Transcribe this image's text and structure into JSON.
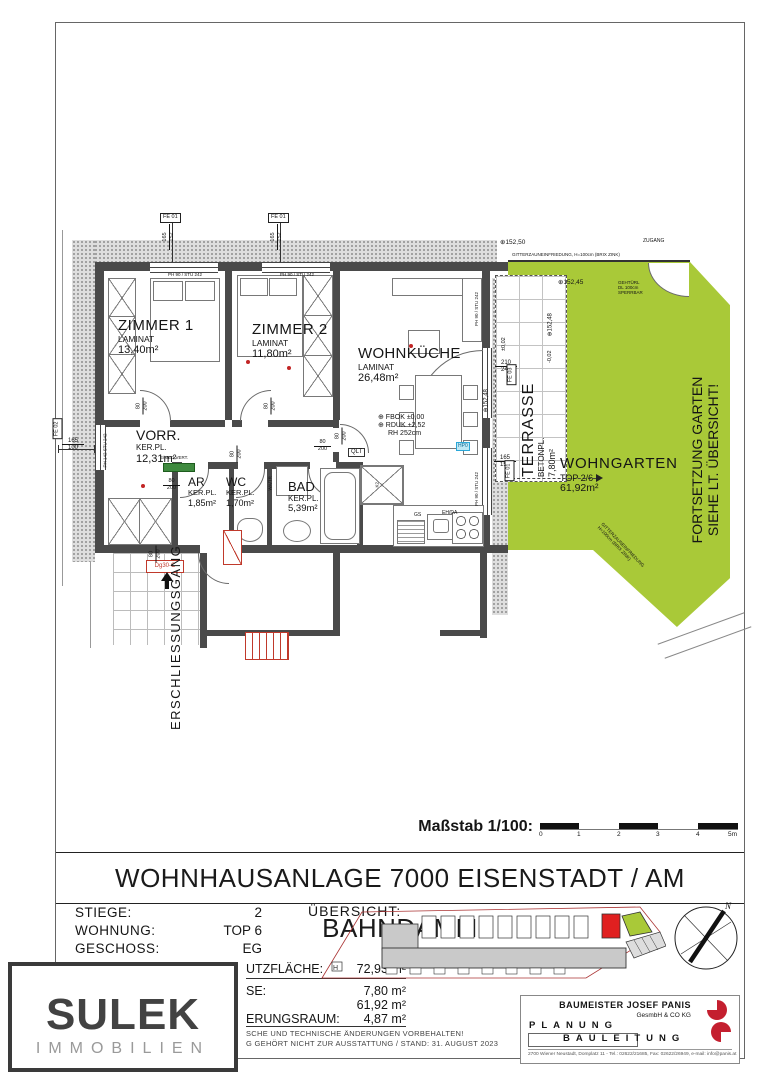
{
  "title": "WOHNHAUSANLAGE 7000 EISENSTADT / AM BAHNDAMM",
  "scalebar": {
    "label": "Maßstab 1/100:",
    "ticks": [
      "0",
      "1",
      "2",
      "3",
      "4",
      "5m"
    ]
  },
  "info": {
    "rows": [
      {
        "label": "STIEGE:",
        "value": "2"
      },
      {
        "label": "WOHNUNG:",
        "value": "TOP 6"
      },
      {
        "label": "GESCHOSS:",
        "value": "EG"
      }
    ],
    "areas": [
      {
        "label": "UTZFLÄCHE:",
        "value": "72,93 m²"
      },
      {
        "label": "SE:",
        "value": "7,80 m²"
      },
      {
        "label": "",
        "value": "61,92 m²"
      },
      {
        "label": "ERUNGSRAUM:",
        "value": "4,87 m²"
      }
    ],
    "uebersicht": "ÜBERSICHT:",
    "disclaimer1": "SCHE UND TECHNISCHE ÄNDERUNGEN VORBEHALTEN!",
    "disclaimer2": "G GEHÖRT NICHT ZUR AUSSTATTUNG / STAND: 31. AUGUST 2023"
  },
  "logo": {
    "name": "SULEK",
    "subtitle": "IMMOBILIEN"
  },
  "architect": {
    "name": "BAUMEISTER JOSEF PANIS",
    "legal": "GesmbH & CO KG",
    "planung": "PLANUNG",
    "bauleitung": "BAULEITUNG",
    "address": "2700 Wiener Neustadt, Domplatz 11 - Tel.: 02622/21685, Fax: 02622/26949, e-mail: info@panis.at"
  },
  "compass": {
    "north": "N"
  },
  "rooms": {
    "zimmer1": {
      "name": "ZIMMER 1",
      "floor": "LAMINAT",
      "area": "13,40m²"
    },
    "zimmer2": {
      "name": "ZIMMER 2",
      "floor": "LAMINAT",
      "area": "11,80m²"
    },
    "wohnkueche": {
      "name": "WOHNKÜCHE",
      "floor": "LAMINAT",
      "area": "26,48m²"
    },
    "vorraum": {
      "name": "VORR.",
      "floor": "KER.PL.",
      "area": "12,31m²"
    },
    "abstellraum": {
      "name": "AR",
      "floor": "KER.PL.",
      "area": "1,85m²"
    },
    "wc": {
      "name": "WC",
      "floor": "KER.PL.",
      "area": "1,70m²"
    },
    "bad": {
      "name": "BAD",
      "floor": "KER.PL.",
      "area": "5,39m²"
    },
    "terrasse": {
      "name": "TERRASSE",
      "floor": "BETONPL.",
      "area": "7,80m²"
    },
    "wohngarten": {
      "name": "WOHNGARTEN",
      "top": "TOP 2/6",
      "area": "61,92m²"
    }
  },
  "labels": {
    "erschliessungsgang": "ERSCHLIESSUNGSGANG",
    "fortsetzung1": "FORTSETZUNG GARTEN",
    "fortsetzung2": "SIEHE LT. ÜBERSICHT!",
    "zugang": "ZUGANG",
    "fence_top": "GITTERZAUNEINFRIEDUNG, H=100cm (BRIX ZINK)",
    "fence_diag1": "GITTERZAUNEINFRIEDUNG",
    "fence_diag2": "H=100cm (BRIX ZINK)",
    "gate1": "GEHTÜRL",
    "gate2": "DL 100cm",
    "gate3": "SPERRBAR",
    "fbok": "⊕ FBOK ±0,00",
    "rduk": "⊕ RDUK +2,52",
    "rh": "RH 252cm",
    "qlt": "QLT",
    "gs": "GS",
    "ehda": "EH/DA",
    "watr": "WA/TR",
    "k2": "K2",
    "hp0": "HP0",
    "emed": "E/MED.VERT.",
    "dg30": "Dg30-C",
    "ph90": "PH 90 / STU 242",
    "ph142_1": "PH 142",
    "ph142_2": "STU 242",
    "lvl_15250": "⊕152,50",
    "lvl_15245": "⊕152,45",
    "lvl_15248": "⊕152,48",
    "lvl_p002": "±0,02",
    "lvl_m002": "-0,02",
    "h_mark": "H"
  },
  "tags": {
    "fe01": "FE 01",
    "fe02": "FE 02",
    "fe03": "FE 03"
  },
  "dims": {
    "d80": "80",
    "d200": "200",
    "d165": "165",
    "d152": "152",
    "d100": "100",
    "d210": "210",
    "d242": "242"
  },
  "colors": {
    "garden": "#a9c938",
    "wall": "#4a4a4a",
    "highlight_red": "#e02020",
    "logo_red": "#c41f2f",
    "tile_blue": "#2aa7d8"
  }
}
